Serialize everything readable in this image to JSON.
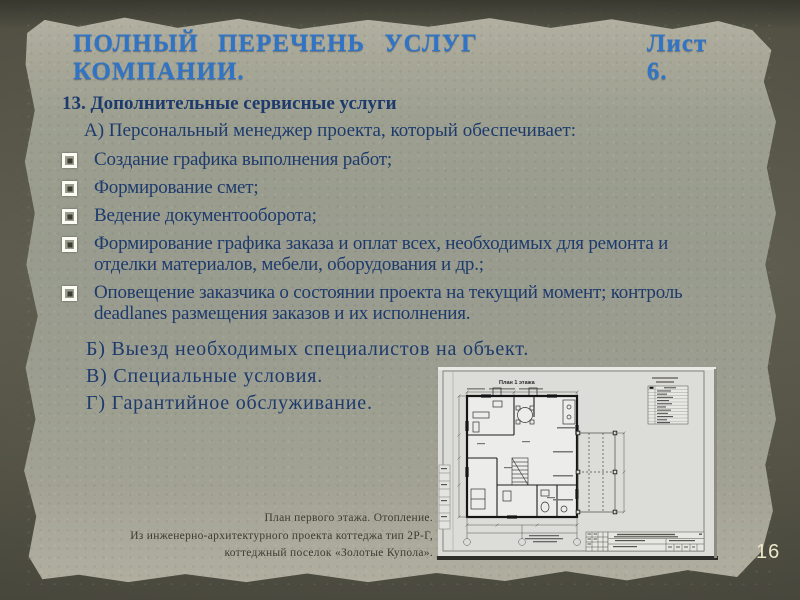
{
  "slide": {
    "title": "ПОЛНЫЙ  ПЕРЕЧЕНЬ  УСЛУГ  КОМПАНИИ.",
    "sheet_label": "Лист 6.",
    "page_number": "16"
  },
  "content": {
    "section_heading": "13. Дополнительные сервисные услуги",
    "subsection_a": "А) Персональный менеджер проекта, который обеспечивает:",
    "bullets": [
      "Создание графика выполнения работ;",
      "Формирование смет;",
      "Ведение документооборота;",
      "Формирование графика заказа и оплат всех, необходимых для ремонта и отделки материалов, мебели, оборудования и др.;",
      "Оповещение заказчика о состоянии проекта на текущий момент; контроль deadlanes размещения заказов и их исполнения."
    ],
    "subsections": [
      "Б) Выезд необходимых специалистов на объект.",
      "В) Специальные условия.",
      "Г) Гарантийное обслуживание."
    ]
  },
  "figure": {
    "plan_label": "План 1 этажа",
    "caption_lines": [
      "План первого этажа. Отопление.",
      "Из инженерно-архитектурного проекта коттеджа тип 2Р-Г,",
      "коттеджный поселок «Золотые Купола»."
    ]
  },
  "colors": {
    "title_blue": "#2f74c6",
    "body_navy": "#1d3a6d",
    "paper_green": "#9a9d8f",
    "border_olive": "#57564a",
    "caption_gray": "#3b3a30",
    "page_number_cream": "#ece8c8",
    "bullet_white": "#fcfcf4"
  }
}
